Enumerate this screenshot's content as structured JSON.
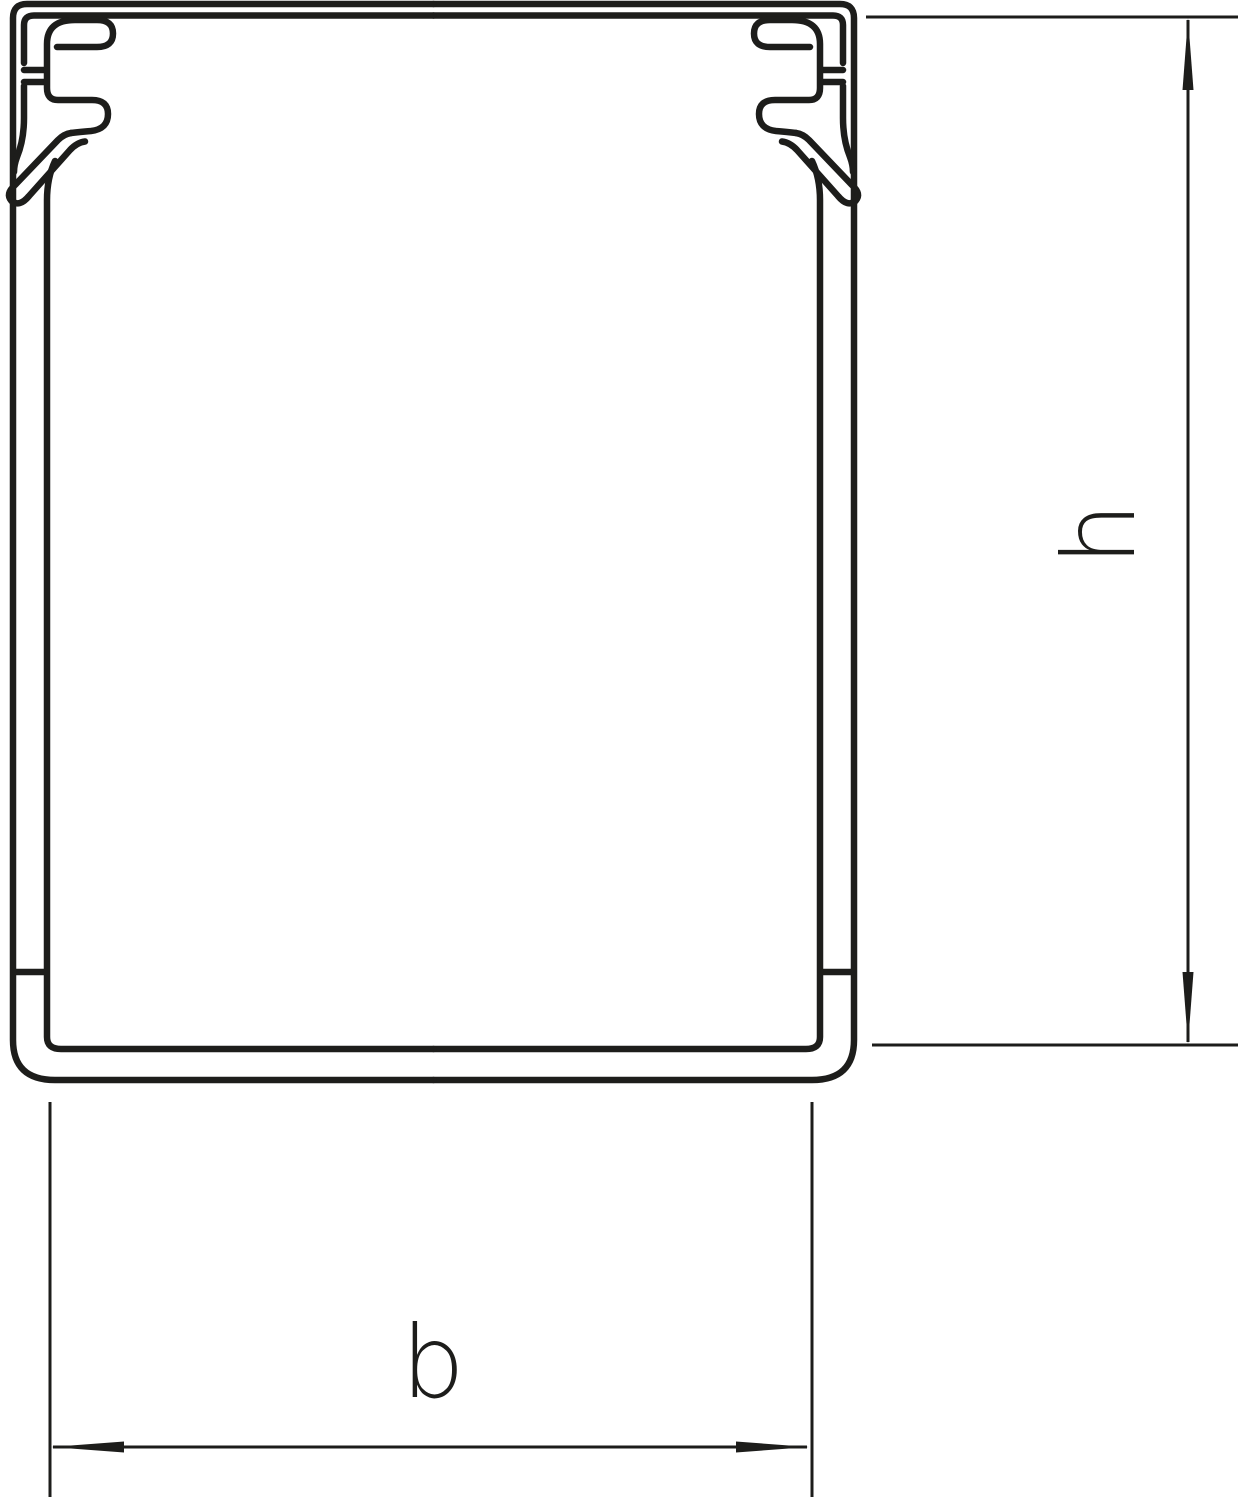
{
  "diagram": {
    "description": "cross-section drawing of a cable trunking duct profile with height and width dimension lines",
    "labels": {
      "height": "h",
      "width": "b"
    },
    "colors": {
      "line": "#1d1d1b",
      "background": "#ffffff"
    }
  }
}
